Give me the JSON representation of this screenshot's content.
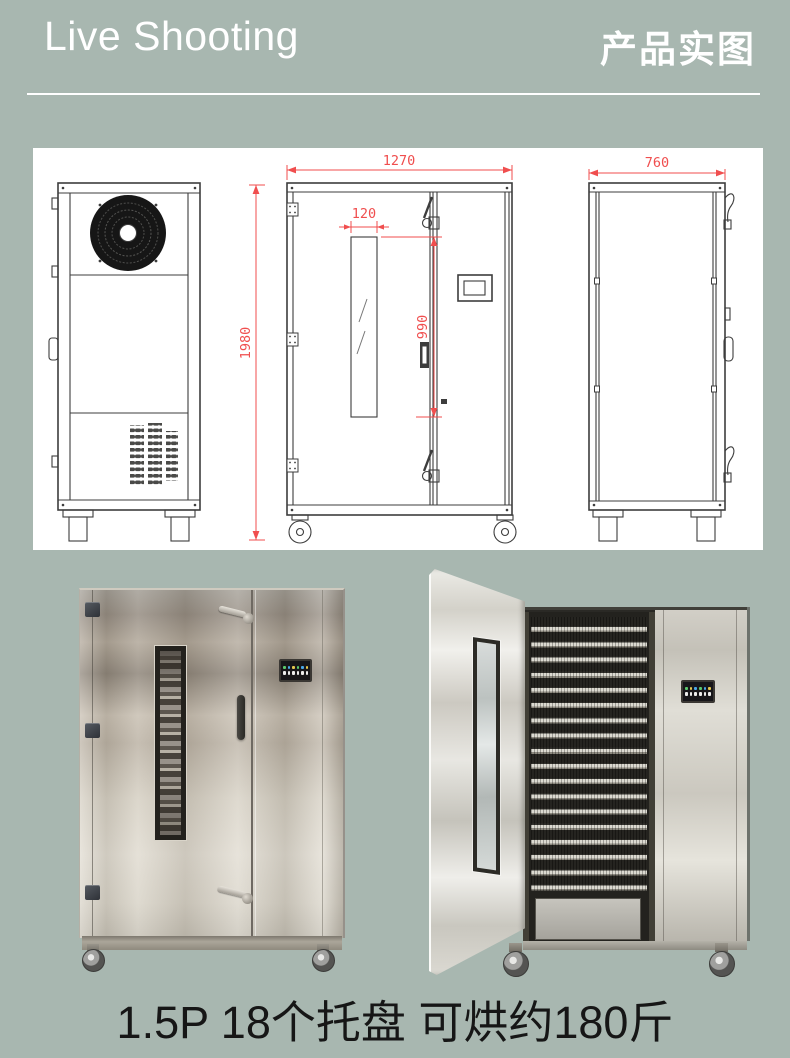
{
  "colors": {
    "background": "#a8b7b0",
    "panel": "#ffffff",
    "dim_red": "#f04e4e",
    "line": "#3d3d3d",
    "text_light": "#ffffff",
    "caption": "#161616"
  },
  "header": {
    "title_en": "Live Shooting",
    "title_zh": "产品实图"
  },
  "drawing": {
    "dims": {
      "front_width": "1270",
      "side_depth": "760",
      "height": "1980",
      "window_width": "120",
      "window_height": "990"
    }
  },
  "photos": {
    "closed": "closed stainless drying cabinet",
    "open": "open cabinet with 18 tray shelves"
  },
  "caption": {
    "text": "1.5P 18个托盘 可烘约180斤"
  }
}
